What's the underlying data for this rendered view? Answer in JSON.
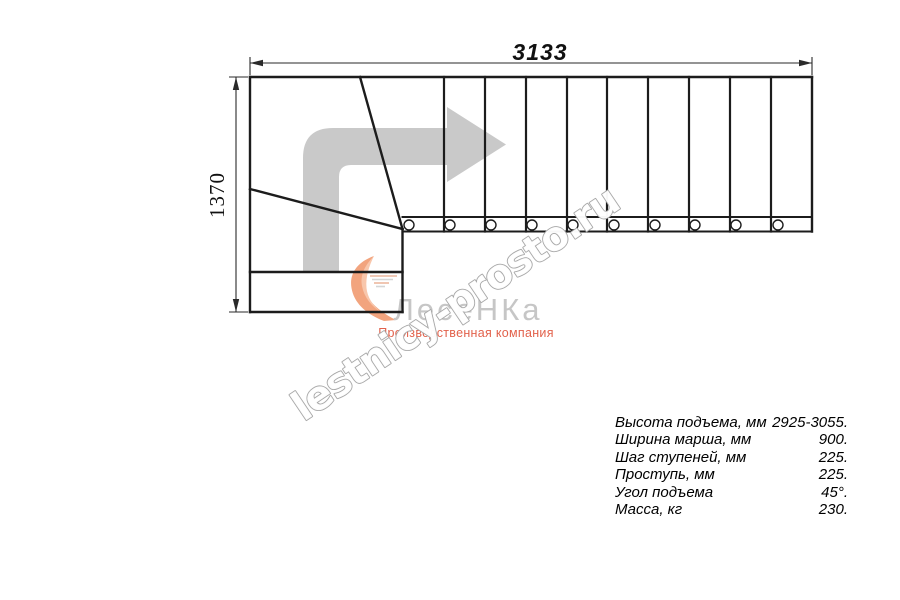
{
  "watermark": {
    "text": "lestnicy-prosto.ru"
  },
  "logo": {
    "name": "ЛесеНКа",
    "tagline": "Производственная компания"
  },
  "dimensions": {
    "width_label": "3133",
    "height_label": "1370"
  },
  "specs": {
    "rows": [
      {
        "label": "Высота подъема, мм",
        "value": "2925-3055."
      },
      {
        "label": "Ширина марша, мм",
        "value": "900."
      },
      {
        "label": "Шаг ступеней, мм",
        "value": "225."
      },
      {
        "label": "Проступь, мм",
        "value": "225."
      },
      {
        "label": "Угол подъема",
        "value": "45°."
      },
      {
        "label": "Масса, кг",
        "value": "230."
      }
    ]
  },
  "colors": {
    "line": "#1c1c1c",
    "direction_arrow": "#c9c9c9",
    "watermark_outline": "#a7a7a7",
    "logo_text": "#c6c6c6",
    "logo_accent": "#f2a47e",
    "tagline": "#e2614b"
  }
}
